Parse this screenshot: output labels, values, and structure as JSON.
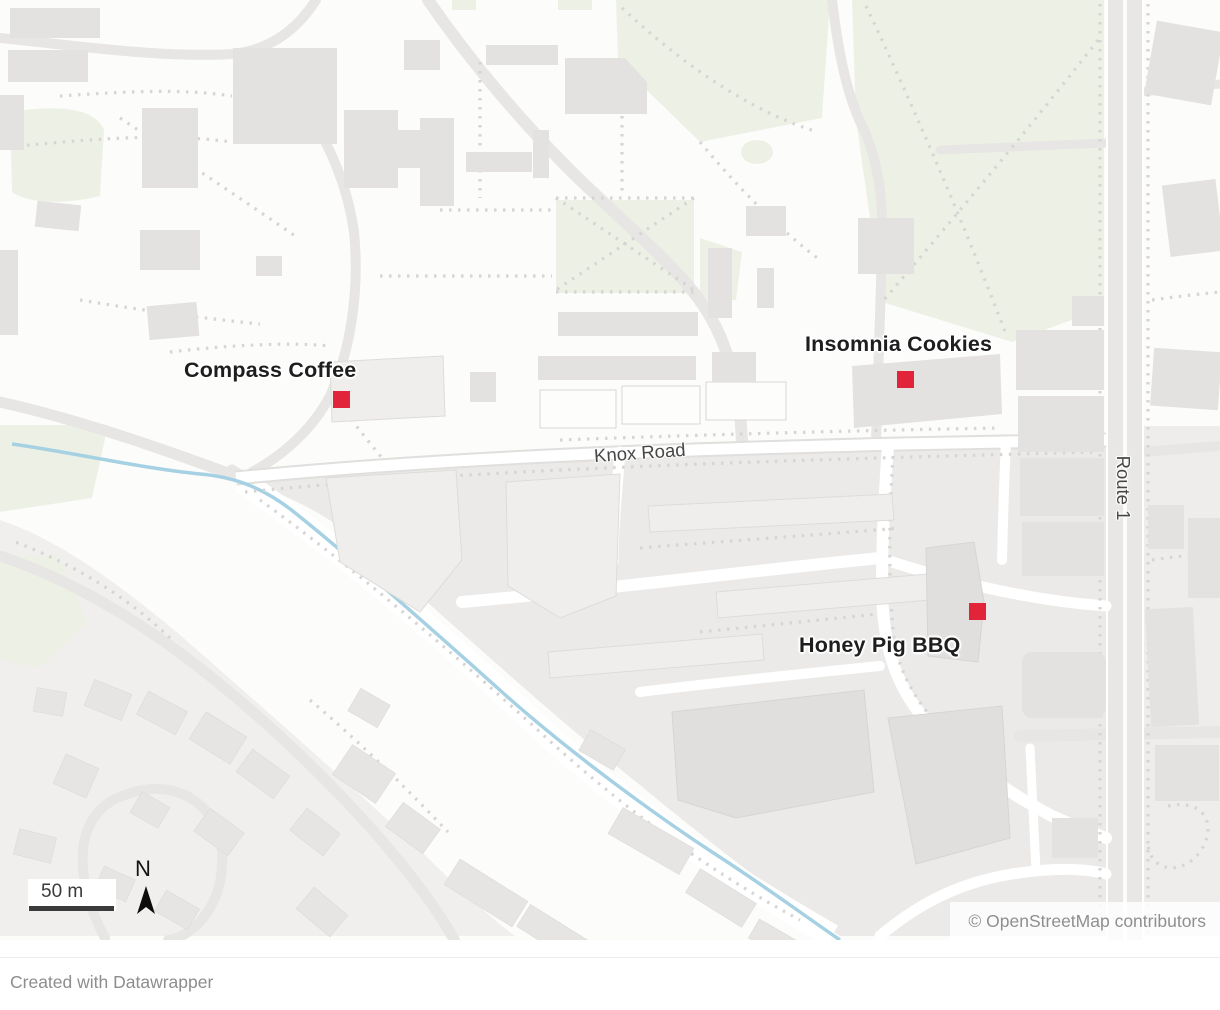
{
  "map": {
    "markers": [
      {
        "id": "compass-coffee",
        "label": "Compass Coffee"
      },
      {
        "id": "insomnia-cookies",
        "label": "Insomnia Cookies"
      },
      {
        "id": "honey-pig-bbq",
        "label": "Honey Pig BBQ"
      }
    ],
    "road_labels": [
      {
        "id": "knox-road",
        "label": "Knox Road"
      },
      {
        "id": "route-1",
        "label": "Route 1"
      }
    ],
    "scale": {
      "label": "50 m"
    },
    "compass": {
      "label": "N"
    },
    "attribution": "© OpenStreetMap contributors"
  },
  "footer": {
    "credit": "Created with Datawrapper"
  },
  "colors": {
    "marker": "#e2243a",
    "water": "#a6d1e3",
    "park": "#edf1e5",
    "building": "#e3e2e0",
    "building_light": "#efeeec",
    "building_dark": "#e0dfdd",
    "house": "#e6e5e3",
    "zone_south": "#ebeae8",
    "zone_residential": "#f0efee",
    "zone_east": "#eeedeb",
    "road": "#e7e6e4",
    "dotted": "#d6d5d3"
  }
}
